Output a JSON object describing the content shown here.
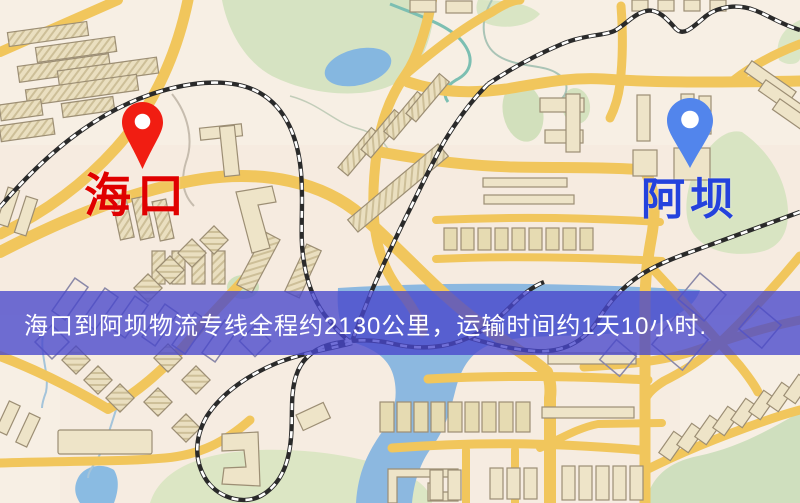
{
  "banner": {
    "text": "海口到阿坝物流专线全程约2130公里，运输时间约1天10小时.",
    "background_color": "#4846cc",
    "text_color": "#ffffff"
  },
  "markers": {
    "origin": {
      "label": "海口",
      "pin_color": "#f11d12",
      "label_color": "#e00000"
    },
    "destination": {
      "label": "阿坝",
      "pin_color": "#5285ec",
      "label_color": "#2442dd"
    }
  },
  "map_palette": {
    "background": "#f7efe4",
    "road": "#f1c65c",
    "park": "#d6e3c2",
    "water": "#8cb8e0",
    "railway": "#2a2a2a",
    "building": "#eee4c8"
  }
}
